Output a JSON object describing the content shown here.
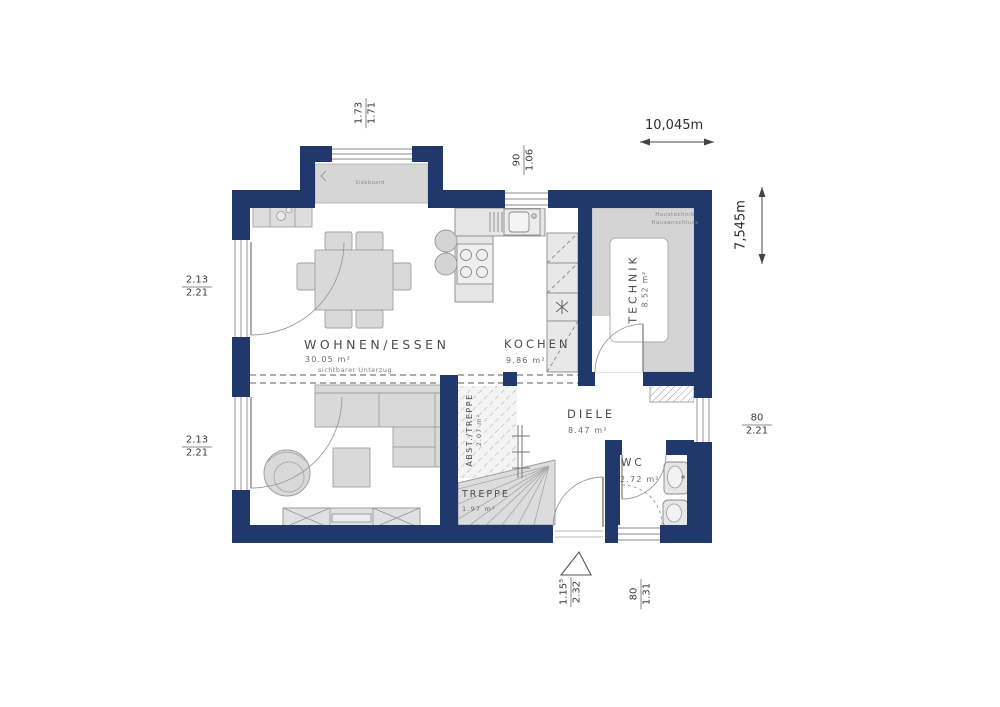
{
  "meta": {
    "background": "#ffffff",
    "wall_color": "#20386b",
    "furniture_color": "#d9d9d9",
    "line_color": "#8a8a8a"
  },
  "rooms": {
    "wohnen": {
      "name": "WOHNEN/ESSEN",
      "area": "30.05 m²"
    },
    "kochen": {
      "name": "KOCHEN",
      "area": "9.86 m²"
    },
    "technik": {
      "name": "TECHNIK",
      "area": "8.52 m²"
    },
    "diele": {
      "name": "DIELE",
      "area": "8.47 m²"
    },
    "wc": {
      "name": "WC",
      "area": "2.72 m²"
    },
    "abstellraum": {
      "name": "ABST./TREPPE",
      "area": "2.07 m²"
    },
    "treppe": {
      "name": "TREPPE",
      "area": "1.97 m²"
    }
  },
  "annotations": {
    "beam": "sichtbarer Unterzug",
    "technik_line1": "Haustechnik",
    "technik_line2": "Hausanschluss",
    "window_band": "Sideboard"
  },
  "dimensions": {
    "overall_width": "10,045m",
    "overall_height": "7,545m",
    "bay_window": {
      "top": "1.73",
      "bottom": "1.71"
    },
    "kitchen_window": {
      "top": "90",
      "bottom": "1.06"
    },
    "terrace_door_upper": {
      "top": "2.13",
      "bottom": "2.21"
    },
    "terrace_door_lower": {
      "top": "2.13",
      "bottom": "2.21"
    },
    "diele_window": {
      "top": "80",
      "bottom": "2.21"
    },
    "entrance_door": {
      "top": "1.15⁵",
      "bottom": "2.32"
    },
    "wc_window": {
      "top": "80",
      "bottom": "1.31"
    }
  }
}
